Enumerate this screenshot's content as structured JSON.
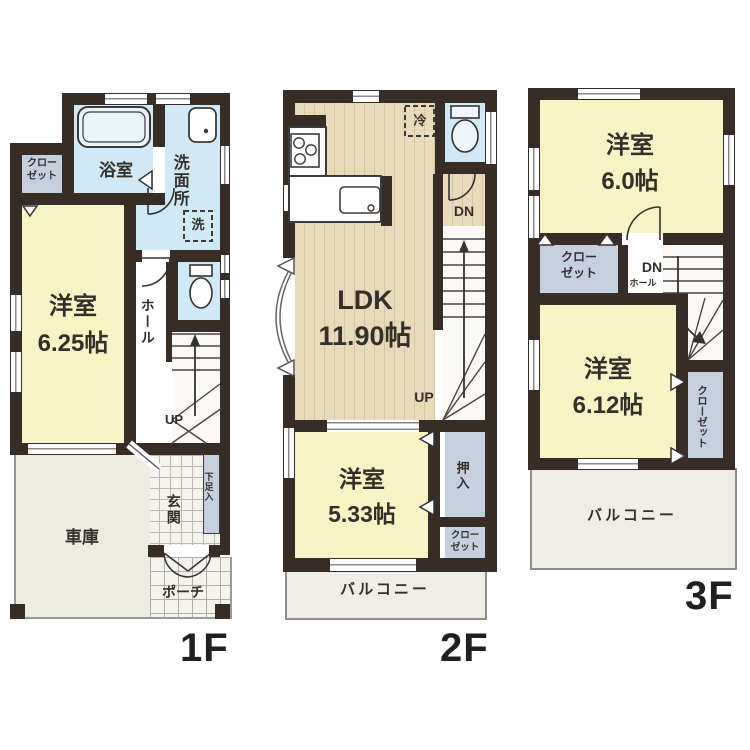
{
  "title": "3-story house floor plan",
  "colors": {
    "wall": "#372d26",
    "room_yellow": "#f7f3c5",
    "water_blue": "#cfe9f6",
    "closet_gray": "#c5cfdf",
    "wood_floor": "#e9dbba",
    "exterior_gray": "#edebe2"
  },
  "floors": {
    "f1": {
      "label": "1F",
      "rooms": {
        "closet": "クロー\nゼット",
        "bath": "浴室",
        "washroom": "洗面所",
        "washer": "洗",
        "bedroom": "洋室\n6.25帖",
        "hall": "ホール",
        "up": "UP",
        "entrance": "玄関",
        "shoebox": "下足入",
        "garage": "車庫",
        "porch": "ポーチ"
      }
    },
    "f2": {
      "label": "2F",
      "rooms": {
        "ldk": "LDK\n11.90帖",
        "fridge": "冷",
        "dn": "DN",
        "up": "UP",
        "bedroom": "洋室\n5.33帖",
        "oshiire": "押入",
        "closet": "クロー\nゼット",
        "balcony": "バルコニー"
      }
    },
    "f3": {
      "label": "3F",
      "rooms": {
        "bedroom1": "洋室\n6.0帖",
        "closet1": "クロー\nゼット",
        "dn": "DN",
        "hall": "ホール",
        "bedroom2": "洋室\n6.12帖",
        "closet2": "クローゼット",
        "balcony": "バルコニー"
      }
    }
  }
}
